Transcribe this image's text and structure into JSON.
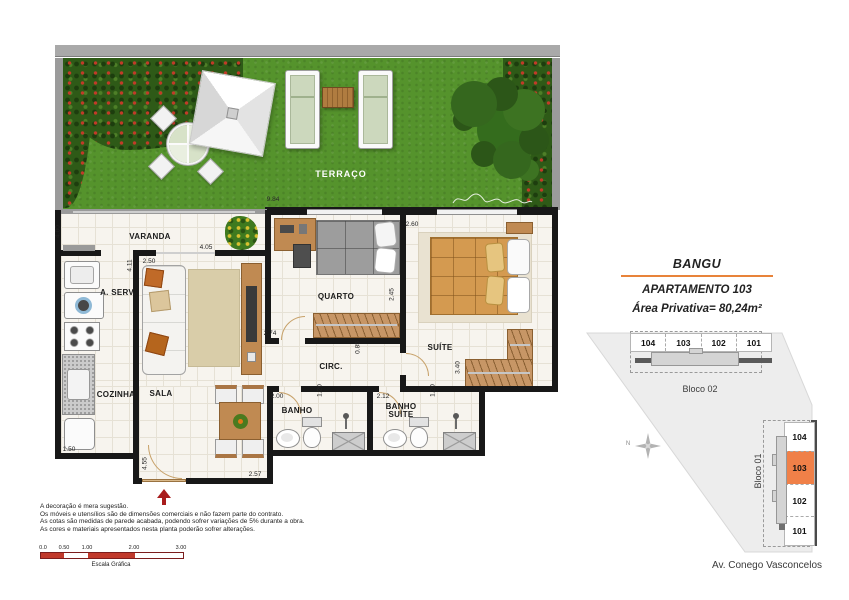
{
  "plan": {
    "terrace_label": "TERRAÇO",
    "rooms": {
      "varanda": "VARANDA",
      "aserv": "A. SERV.",
      "cozinha": "COZINHA",
      "sala": "SALA",
      "quarto": "QUARTO",
      "circ": "CIRC.",
      "suite": "SUÍTE",
      "banho": "BANHO",
      "banho_suite": "BANHO SUÍTE"
    },
    "dims": [
      "9.84",
      "4.00",
      "4.11",
      "2.50",
      "4.05",
      "2.60",
      "2.45",
      "2.74",
      "0.85",
      "3.40",
      "2.00",
      "1.20",
      "2.12",
      "1.20",
      "4.55",
      "2.57",
      "1.50"
    ],
    "entrance_arrow_color": "#a81c1c"
  },
  "info_panel": {
    "project": "BANGU",
    "apartment": "APARTAMENTO 103",
    "area": "Área Privativa= 80,24m²",
    "accent_color": "#e8833a"
  },
  "site_plan": {
    "bloco02": {
      "label": "Bloco 02",
      "units": [
        "104",
        "103",
        "102",
        "101"
      ]
    },
    "bloco01": {
      "label": "Bloco 01",
      "units": [
        "104",
        "103",
        "102",
        "101"
      ],
      "highlighted_unit": "103"
    },
    "street_label": "Av. Conego Vasconcelos",
    "compass_label": "N",
    "highlight_color": "#f08048"
  },
  "disclaimer": {
    "lines": [
      "A decoração é mera sugestão.",
      "Os móveis e utensílios são de dimensões comerciais e não fazem parte do contrato.",
      "As cotas são medidas de parede acabada, podendo sofrer variações de 5% durante a obra.",
      "As cores e materiais apresentados nesta planta poderão sofrer alterações."
    ]
  },
  "scale_bar": {
    "label": "Escala Gráfica",
    "ticks": [
      "0.0",
      "0.50",
      "1.00",
      "2.00",
      "3.00"
    ]
  }
}
